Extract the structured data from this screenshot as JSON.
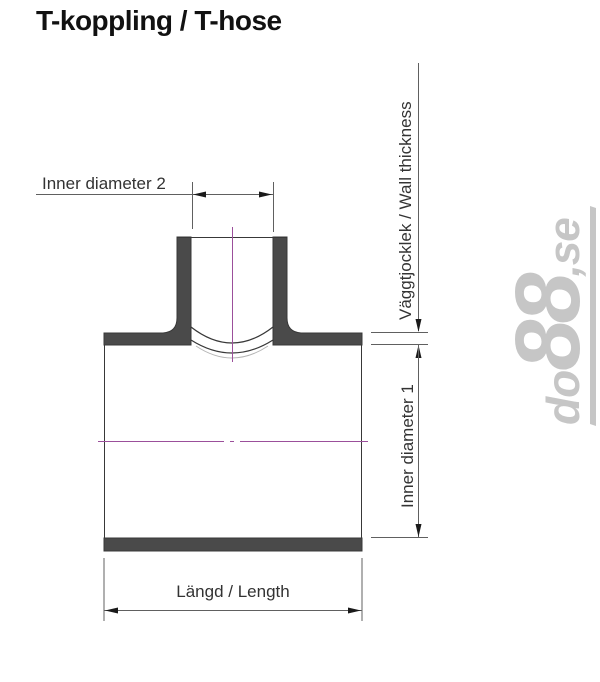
{
  "page": {
    "title": "T-koppling / T-hose"
  },
  "diagram": {
    "type": "technical-drawing",
    "labels": {
      "inner_diameter_2": "Inner diameter 2",
      "wall_thickness": "Väggtjocklek / Wall thickness",
      "inner_diameter_1": "Inner diameter 1",
      "length": "Längd / Length"
    },
    "colors": {
      "part_fill": "#4a4a4a",
      "outline": "#383838",
      "dimension_lines": "#606060",
      "arrowheads": "#1a1a1a",
      "centerline": "#9b4f9b",
      "faint_arc": "#b5b5b5"
    }
  },
  "watermark": {
    "do": "do",
    "digits": "88",
    "se": ",se",
    "color": "#c6c6c6"
  }
}
